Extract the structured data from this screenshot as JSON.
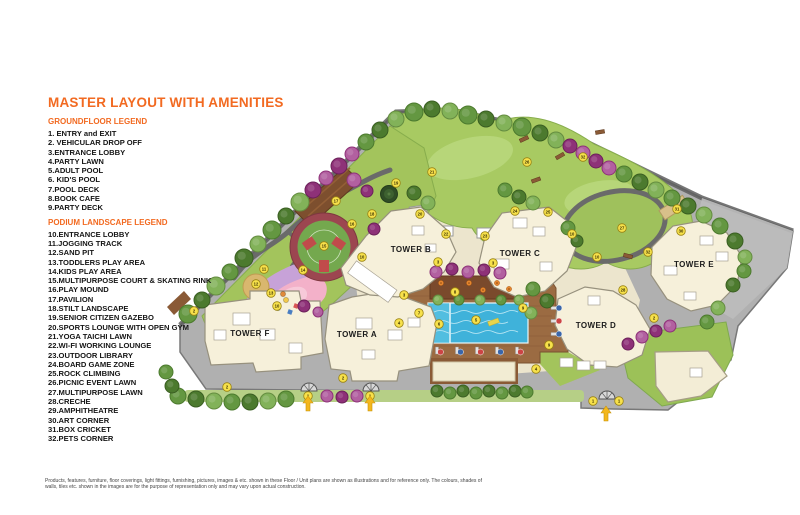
{
  "title": "MASTER LAYOUT WITH AMENITIES",
  "legend_groundfloor": {
    "heading": "GROUNDFLOOR LEGEND",
    "items": [
      "1. ENTRY and EXIT",
      "2. VEHICULAR DROP OFF",
      "3.ENTRANCE LOBBY",
      "4.PARTY LAWN",
      "5.ADULT POOL",
      "6. KID'S POOL",
      "7.POOL DECK",
      "8.BOOK CAFE",
      "9.PARTY DECK"
    ]
  },
  "legend_podium": {
    "heading": "PODIUM LANDSCAPE LEGEND",
    "items": [
      "10.ENTRANCE LOBBY",
      "11.JOGGING TRACK",
      "12.SAND PIT",
      "13.TODDLERS PLAY AREA",
      "14.KIDS PLAY AREA",
      "15.MULTIPURPOSE COURT & SKATING RINK",
      "16.PLAY MOUND",
      "17.PAVILION",
      "18.STILT LANDSCAPE",
      "19.SENIOR CITIZEN GAZEBO",
      "20.SPORTS LOUNGE WITH OPEN GYM",
      "21.YOGA TAICHI LAWN",
      "22.WI-FI WORKING LOUNGE",
      "23.OUTDOOR LIBRARY",
      "24.BOARD GAME ZONE",
      "25.ROCK CLIMBING",
      "26.PICNIC EVENT LAWN",
      "27.MULTIPURPOSE LAWN",
      "28.CRECHE",
      "29.AMPHITHEATRE",
      "30.ART CORNER",
      "31.BOX CRICKET",
      "32.PETS CORNER"
    ]
  },
  "disclaimer": [
    "Products, features, furniture, floor coverings, light fittings, furnishing, pictures, images & etc. shown in these Floor / Unit plans are shown as illustrations and for reference only. The colours, shades of",
    "walls, tiles etc. shown in the images are for the purpose of representation only and may vary upon actual construction."
  ],
  "colors": {
    "accent_orange": "#f26a21",
    "marker_fill": "#f7e14b",
    "marker_stroke": "#9a8312",
    "arrow_gold": "#f3b71c",
    "pool_blue": "#3fb2da",
    "deck_wood": "#9b6b42",
    "tower_cream": "#f6f0da",
    "lawn_green": "#a8ca62",
    "paving_gray": "#b0b0b0"
  },
  "map": {
    "towers": [
      {
        "label": "TOWER F",
        "x": 250,
        "y": 336
      },
      {
        "label": "TOWER A",
        "x": 357,
        "y": 337
      },
      {
        "label": "TOWER B",
        "x": 411,
        "y": 252
      },
      {
        "label": "TOWER C",
        "x": 520,
        "y": 256
      },
      {
        "label": "TOWER D",
        "x": 596,
        "y": 328
      },
      {
        "label": "TOWER E",
        "x": 694,
        "y": 267
      }
    ],
    "markers": [
      [
        "1",
        308,
        396
      ],
      [
        "1",
        370,
        396
      ],
      [
        "1",
        593,
        401
      ],
      [
        "1",
        619,
        401
      ],
      [
        "2",
        194,
        311
      ],
      [
        "2",
        227,
        387
      ],
      [
        "2",
        343,
        378
      ],
      [
        "2",
        654,
        318
      ],
      [
        "3",
        404,
        295
      ],
      [
        "3",
        438,
        262
      ],
      [
        "3",
        493,
        263
      ],
      [
        "4",
        399,
        323
      ],
      [
        "4",
        536,
        369
      ],
      [
        "5",
        476,
        320
      ],
      [
        "6",
        439,
        324
      ],
      [
        "7",
        419,
        313
      ],
      [
        "8",
        455,
        292
      ],
      [
        "9",
        523,
        308
      ],
      [
        "9",
        549,
        345
      ],
      [
        "10",
        362,
        257
      ],
      [
        "10",
        277,
        306
      ],
      [
        "10",
        572,
        234
      ],
      [
        "10",
        597,
        257
      ],
      [
        "11",
        264,
        269
      ],
      [
        "12",
        256,
        284
      ],
      [
        "13",
        271,
        293
      ],
      [
        "14",
        303,
        270
      ],
      [
        "15",
        324,
        246
      ],
      [
        "16",
        352,
        224
      ],
      [
        "17",
        336,
        201
      ],
      [
        "18",
        372,
        214
      ],
      [
        "19",
        396,
        183
      ],
      [
        "20",
        420,
        214
      ],
      [
        "21",
        432,
        172
      ],
      [
        "22",
        446,
        234
      ],
      [
        "23",
        485,
        236
      ],
      [
        "24",
        515,
        211
      ],
      [
        "25",
        548,
        212
      ],
      [
        "26",
        527,
        162
      ],
      [
        "27",
        622,
        228
      ],
      [
        "28",
        623,
        290
      ],
      [
        "30",
        681,
        231
      ],
      [
        "31",
        677,
        209
      ],
      [
        "32",
        583,
        157
      ],
      [
        "32",
        648,
        252
      ]
    ],
    "tree_colors": {
      "g1": [
        "#4c7a2e",
        "#3a5e22"
      ],
      "g2": [
        "#649741",
        "#4c7a2e"
      ],
      "g3": [
        "#82b259",
        "#648c40"
      ],
      "p1": [
        "#8e3178",
        "#6b2159"
      ],
      "p2": [
        "#b260a0",
        "#8e3178"
      ]
    },
    "trees": [
      [
        188,
        314,
        9,
        "g2"
      ],
      [
        202,
        300,
        8,
        "g1"
      ],
      [
        216,
        286,
        9,
        "g3"
      ],
      [
        230,
        272,
        8,
        "g2"
      ],
      [
        244,
        258,
        9,
        "g1"
      ],
      [
        258,
        244,
        8,
        "g3"
      ],
      [
        272,
        230,
        9,
        "g2"
      ],
      [
        286,
        216,
        8,
        "g1"
      ],
      [
        300,
        202,
        9,
        "g3"
      ],
      [
        313,
        190,
        8,
        "p1"
      ],
      [
        326,
        178,
        7,
        "p2"
      ],
      [
        339,
        166,
        8,
        "p1"
      ],
      [
        352,
        154,
        7,
        "p2"
      ],
      [
        366,
        142,
        8,
        "g2"
      ],
      [
        380,
        130,
        8,
        "g1"
      ],
      [
        396,
        119,
        8,
        "g3"
      ],
      [
        414,
        112,
        9,
        "g2"
      ],
      [
        432,
        109,
        8,
        "g1"
      ],
      [
        450,
        111,
        8,
        "g3"
      ],
      [
        468,
        115,
        9,
        "g2"
      ],
      [
        486,
        119,
        8,
        "g1"
      ],
      [
        504,
        123,
        8,
        "g3"
      ],
      [
        522,
        127,
        9,
        "g2"
      ],
      [
        540,
        133,
        8,
        "g1"
      ],
      [
        556,
        140,
        8,
        "g3"
      ],
      [
        570,
        146,
        7,
        "p1"
      ],
      [
        583,
        153,
        7,
        "p2"
      ],
      [
        596,
        161,
        7,
        "p1"
      ],
      [
        609,
        168,
        7,
        "p2"
      ],
      [
        624,
        174,
        8,
        "g2"
      ],
      [
        640,
        182,
        8,
        "g1"
      ],
      [
        656,
        190,
        8,
        "g3"
      ],
      [
        672,
        198,
        8,
        "g2"
      ],
      [
        688,
        206,
        8,
        "g1"
      ],
      [
        704,
        215,
        8,
        "g3"
      ],
      [
        720,
        226,
        8,
        "g2"
      ],
      [
        735,
        241,
        8,
        "g1"
      ],
      [
        745,
        257,
        7,
        "g3"
      ],
      [
        744,
        271,
        7,
        "g2"
      ],
      [
        733,
        285,
        7,
        "g1"
      ],
      [
        718,
        308,
        7,
        "g3"
      ],
      [
        707,
        322,
        7,
        "g2"
      ],
      [
        178,
        396,
        8,
        "g2"
      ],
      [
        196,
        399,
        8,
        "g1"
      ],
      [
        214,
        401,
        8,
        "g3"
      ],
      [
        232,
        402,
        8,
        "g2"
      ],
      [
        250,
        402,
        8,
        "g1"
      ],
      [
        268,
        401,
        8,
        "g3"
      ],
      [
        286,
        399,
        8,
        "g2"
      ],
      [
        327,
        396,
        6,
        "p2"
      ],
      [
        342,
        397,
        6,
        "p1"
      ],
      [
        357,
        396,
        6,
        "p2"
      ],
      [
        628,
        344,
        6,
        "p1"
      ],
      [
        642,
        337,
        6,
        "p2"
      ],
      [
        656,
        331,
        6,
        "p1"
      ],
      [
        670,
        326,
        6,
        "p2"
      ],
      [
        354,
        180,
        7,
        "p2"
      ],
      [
        367,
        191,
        6,
        "p1"
      ],
      [
        374,
        229,
        6,
        "p1"
      ],
      [
        304,
        306,
        6,
        "p1"
      ],
      [
        318,
        312,
        5,
        "p2"
      ],
      [
        436,
        272,
        6,
        "p2"
      ],
      [
        452,
        269,
        6,
        "p1"
      ],
      [
        468,
        272,
        6,
        "p2"
      ],
      [
        484,
        270,
        6,
        "p1"
      ],
      [
        500,
        273,
        6,
        "p2"
      ],
      [
        505,
        190,
        7,
        "g2"
      ],
      [
        519,
        197,
        7,
        "g1"
      ],
      [
        533,
        203,
        7,
        "g3"
      ],
      [
        568,
        228,
        7,
        "g2"
      ],
      [
        577,
        241,
        6,
        "g1"
      ],
      [
        533,
        289,
        7,
        "g2"
      ],
      [
        547,
        301,
        7,
        "g1"
      ],
      [
        531,
        313,
        6,
        "g3"
      ],
      [
        414,
        193,
        7,
        "g1"
      ],
      [
        428,
        203,
        7,
        "g3"
      ],
      [
        166,
        372,
        7,
        "g2"
      ],
      [
        172,
        386,
        7,
        "g1"
      ],
      [
        438,
        300,
        5,
        "g3"
      ],
      [
        459,
        300,
        5,
        "g2"
      ],
      [
        480,
        300,
        5,
        "g3"
      ],
      [
        501,
        300,
        5,
        "g2"
      ],
      [
        519,
        300,
        5,
        "g3"
      ],
      [
        437,
        391,
        6,
        "g1"
      ],
      [
        450,
        393,
        6,
        "g2"
      ],
      [
        463,
        391,
        6,
        "g1"
      ],
      [
        476,
        393,
        6,
        "g2"
      ],
      [
        489,
        391,
        6,
        "g1"
      ],
      [
        502,
        393,
        6,
        "g2"
      ],
      [
        515,
        391,
        6,
        "g1"
      ],
      [
        527,
        392,
        6,
        "g2"
      ]
    ],
    "benches": [
      [
        524,
        139,
        -25
      ],
      [
        560,
        156,
        -30
      ],
      [
        536,
        180,
        -20
      ],
      [
        600,
        132,
        -10
      ],
      [
        628,
        256,
        15
      ]
    ],
    "cafe_tables": [
      [
        441,
        283
      ],
      [
        455,
        290
      ],
      [
        469,
        283
      ],
      [
        483,
        290
      ],
      [
        497,
        283
      ],
      [
        509,
        289
      ]
    ],
    "loungers_bottom": [
      [
        437,
        350,
        0
      ],
      [
        457,
        350,
        1
      ],
      [
        477,
        350,
        0
      ],
      [
        497,
        350,
        1
      ],
      [
        517,
        350,
        0
      ]
    ],
    "loungers_right": [
      [
        556,
        308,
        1
      ],
      [
        556,
        321,
        0
      ],
      [
        556,
        334,
        1
      ]
    ],
    "play_items": [
      [
        286,
        300,
        "c",
        "#f2c94c"
      ],
      [
        296,
        306,
        "s",
        "#d95555"
      ],
      [
        278,
        308,
        "c",
        "#58a55c"
      ],
      [
        290,
        312,
        "s",
        "#4a7ec2"
      ],
      [
        283,
        294,
        "c",
        "#e08a3a"
      ]
    ],
    "arrows": [
      [
        308,
        404
      ],
      [
        370,
        404
      ],
      [
        606,
        414
      ]
    ],
    "gates": [
      [
        309,
        391
      ],
      [
        371,
        391
      ],
      [
        607,
        399
      ]
    ]
  }
}
